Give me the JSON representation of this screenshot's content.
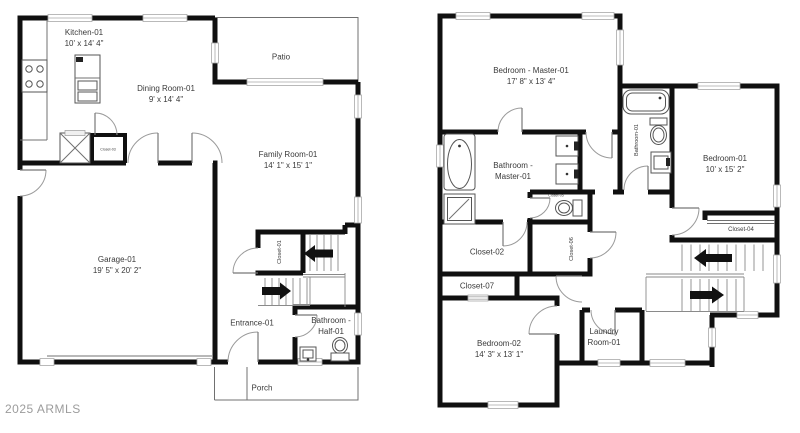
{
  "watermark": "2025 ARMLS",
  "floor1": {
    "kitchen_name": "Kitchen-01",
    "kitchen_dims": "10' x 14' 4\"",
    "dining_name": "Dining Room-01",
    "dining_dims": "9' x 14' 4\"",
    "patio": "Patio",
    "family_name": "Family Room-01",
    "family_dims": "14' 1\" x 15' 1\"",
    "garage_name": "Garage-01",
    "garage_dims": "19' 5\" x 20' 2\"",
    "entrance": "Entrance-01",
    "half_bath_line1": "Bathroom -",
    "half_bath_line2": "Half-01",
    "porch": "Porch",
    "closet1": "Closet-01",
    "closet3": "Closet-03"
  },
  "floor2": {
    "master_bed_name": "Bedroom - Master-01",
    "master_bed_dims": "17' 8\" x 13' 4\"",
    "master_bath_line1": "Bathroom -",
    "master_bath_line2": "Master-01",
    "bathroom1": "Bathroom-01",
    "bedroom1_name": "Bedroom-01",
    "bedroom1_dims": "10' x 15' 2\"",
    "bedroom2_name": "Bedroom-02",
    "bedroom2_dims": "14' 3\" x 13' 1\"",
    "laundry_line1": "Laundry",
    "laundry_line2": "Room-01",
    "closet2": "Closet-02",
    "closet4": "Closet-04",
    "closet5": "Closet-05",
    "closet6": "Closet-06",
    "closet7": "Closet-07"
  },
  "stairs": {
    "floor1_up_arrow": "left",
    "floor1_down_arrow": "right",
    "floor2_up_arrow": "left",
    "floor2_down_arrow": "right"
  }
}
